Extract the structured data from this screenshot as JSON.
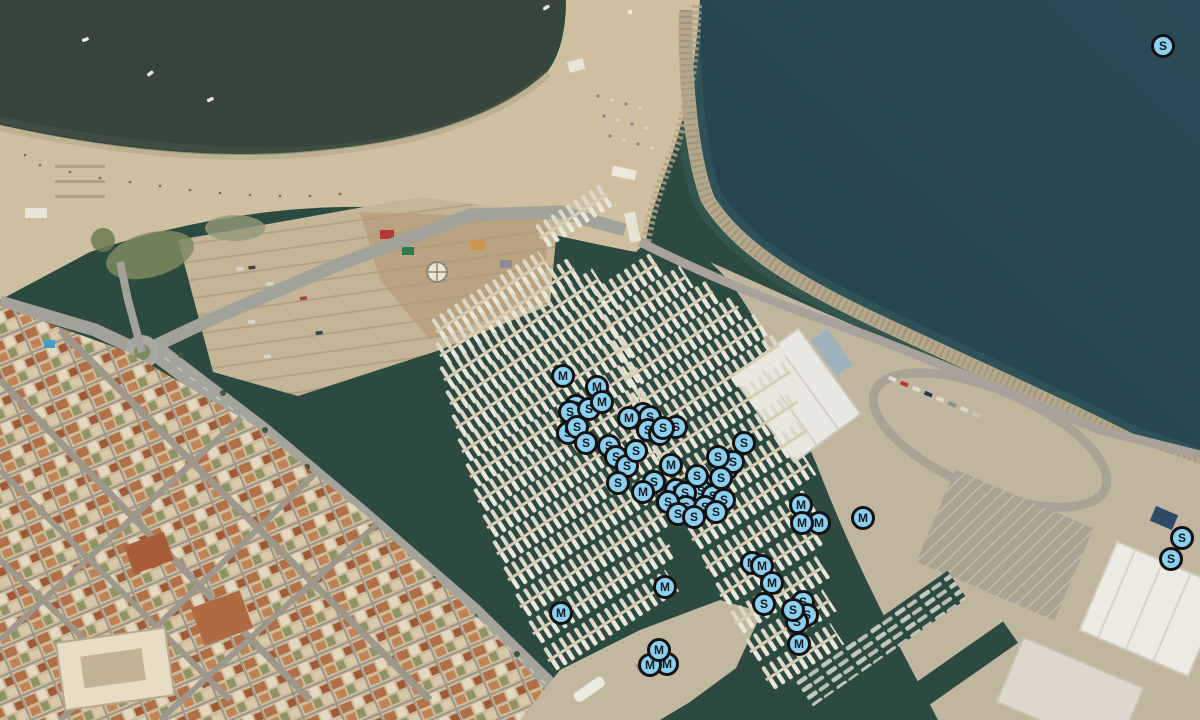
{
  "map": {
    "view_label": "satellite",
    "colors": {
      "marker_fill": "#8CD0F1",
      "marker_border": "#121212",
      "marker_text": "#10181d",
      "marina_water": "#2d4a41",
      "open_sea": "#2a4b57",
      "lagoon": "#36463c",
      "sand": "#cdbf9f",
      "quay_concrete": "#c0b6a0",
      "town_base": "#cdbc9c"
    },
    "marker_letters": [
      "M",
      "S"
    ],
    "markers": [
      {
        "x": 576,
        "y": 406,
        "label": "S"
      },
      {
        "x": 570,
        "y": 412,
        "label": "S"
      },
      {
        "x": 589,
        "y": 409,
        "label": "S"
      },
      {
        "x": 597,
        "y": 387,
        "label": "M"
      },
      {
        "x": 602,
        "y": 402,
        "label": "M"
      },
      {
        "x": 568,
        "y": 433,
        "label": "S"
      },
      {
        "x": 577,
        "y": 427,
        "label": "S"
      },
      {
        "x": 586,
        "y": 443,
        "label": "S"
      },
      {
        "x": 563,
        "y": 376,
        "label": "M"
      },
      {
        "x": 643,
        "y": 414,
        "label": "S"
      },
      {
        "x": 650,
        "y": 417,
        "label": "S"
      },
      {
        "x": 629,
        "y": 418,
        "label": "M"
      },
      {
        "x": 648,
        "y": 430,
        "label": "S"
      },
      {
        "x": 660,
        "y": 434,
        "label": "S"
      },
      {
        "x": 676,
        "y": 427,
        "label": "S"
      },
      {
        "x": 663,
        "y": 428,
        "label": "S"
      },
      {
        "x": 609,
        "y": 446,
        "label": "S"
      },
      {
        "x": 616,
        "y": 457,
        "label": "S"
      },
      {
        "x": 627,
        "y": 466,
        "label": "S"
      },
      {
        "x": 636,
        "y": 451,
        "label": "S"
      },
      {
        "x": 618,
        "y": 483,
        "label": "S"
      },
      {
        "x": 654,
        "y": 482,
        "label": "S"
      },
      {
        "x": 643,
        "y": 492,
        "label": "M"
      },
      {
        "x": 707,
        "y": 487,
        "label": "S"
      },
      {
        "x": 701,
        "y": 491,
        "label": "S"
      },
      {
        "x": 713,
        "y": 496,
        "label": "S"
      },
      {
        "x": 724,
        "y": 500,
        "label": "S"
      },
      {
        "x": 676,
        "y": 490,
        "label": "S"
      },
      {
        "x": 685,
        "y": 493,
        "label": "S"
      },
      {
        "x": 686,
        "y": 507,
        "label": "S"
      },
      {
        "x": 705,
        "y": 507,
        "label": "S"
      },
      {
        "x": 716,
        "y": 512,
        "label": "S"
      },
      {
        "x": 697,
        "y": 476,
        "label": "S"
      },
      {
        "x": 668,
        "y": 502,
        "label": "S"
      },
      {
        "x": 678,
        "y": 514,
        "label": "S"
      },
      {
        "x": 694,
        "y": 517,
        "label": "S"
      },
      {
        "x": 671,
        "y": 465,
        "label": "M"
      },
      {
        "x": 726,
        "y": 470,
        "label": "S"
      },
      {
        "x": 733,
        "y": 462,
        "label": "S"
      },
      {
        "x": 718,
        "y": 457,
        "label": "S"
      },
      {
        "x": 744,
        "y": 443,
        "label": "S"
      },
      {
        "x": 721,
        "y": 478,
        "label": "S"
      },
      {
        "x": 801,
        "y": 505,
        "label": "M"
      },
      {
        "x": 819,
        "y": 523,
        "label": "M"
      },
      {
        "x": 802,
        "y": 523,
        "label": "M"
      },
      {
        "x": 863,
        "y": 518,
        "label": "M"
      },
      {
        "x": 752,
        "y": 563,
        "label": "M"
      },
      {
        "x": 762,
        "y": 566,
        "label": "M"
      },
      {
        "x": 772,
        "y": 583,
        "label": "M"
      },
      {
        "x": 764,
        "y": 604,
        "label": "S"
      },
      {
        "x": 803,
        "y": 602,
        "label": "S"
      },
      {
        "x": 807,
        "y": 615,
        "label": "S"
      },
      {
        "x": 797,
        "y": 622,
        "label": "S"
      },
      {
        "x": 793,
        "y": 610,
        "label": "S"
      },
      {
        "x": 799,
        "y": 644,
        "label": "M"
      },
      {
        "x": 667,
        "y": 664,
        "label": "M"
      },
      {
        "x": 650,
        "y": 665,
        "label": "M"
      },
      {
        "x": 659,
        "y": 650,
        "label": "M"
      },
      {
        "x": 665,
        "y": 587,
        "label": "M"
      },
      {
        "x": 561,
        "y": 613,
        "label": "M"
      },
      {
        "x": 1163,
        "y": 46,
        "label": "S"
      },
      {
        "x": 1171,
        "y": 559,
        "label": "S"
      },
      {
        "x": 1182,
        "y": 538,
        "label": "S"
      }
    ]
  }
}
